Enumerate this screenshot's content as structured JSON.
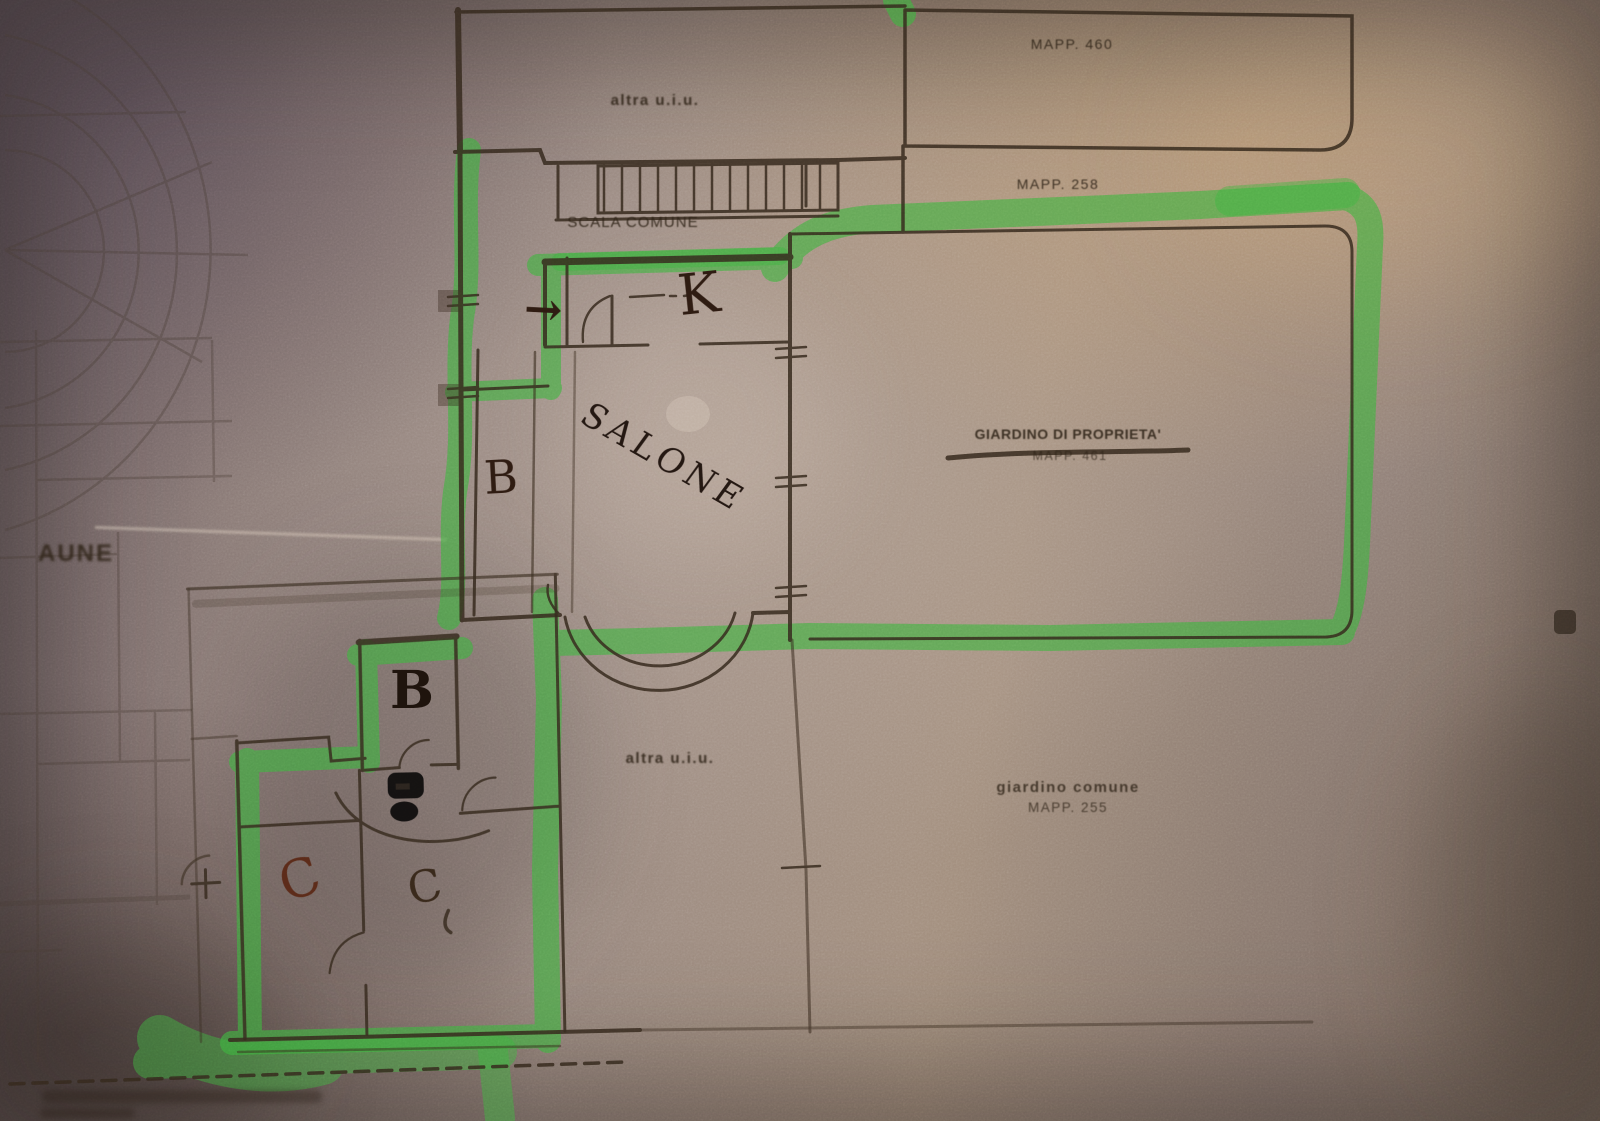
{
  "plan_labels": {
    "mapp_460": "MAPP. 460",
    "altra_uiu_top": "altra u.i.u.",
    "mapp_258": "MAPP. 258",
    "scala_comune": "SCALA COMUNE",
    "giardino_proprieta": "GIARDINO DI PROPRIETA'",
    "mapp_461": "MAPP. 461",
    "salone": "SALONE",
    "altra_uiu_bottom": "altra u.i.u.",
    "giardino_comune_line1": "giardino comune",
    "giardino_comune_line2": "MAPP. 255",
    "edge_fragment": "AUNE"
  },
  "handwritten": {
    "k": "K",
    "arrow": "→",
    "b_corridor": "B",
    "b_room": "B",
    "c_left": "C",
    "c_right": "C"
  },
  "colors": {
    "highlighter_green": "#3cb43e",
    "ink": "#35291d",
    "handwriting_dark": "#2f1c12",
    "handwriting_red": "#5d2c1a",
    "paper_base": "#8f7f78"
  }
}
